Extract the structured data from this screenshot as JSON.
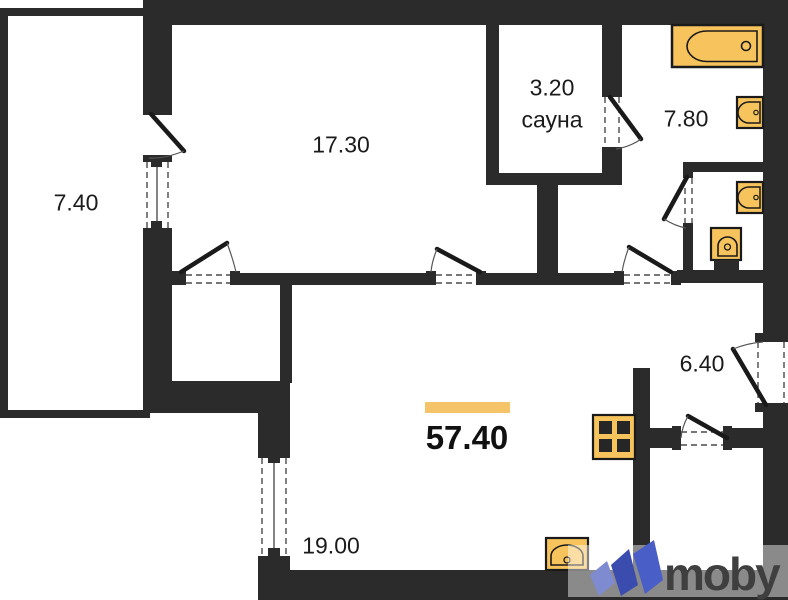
{
  "floorplan": {
    "total_area": "57.40",
    "rooms": [
      {
        "id": "balcony",
        "area": "7.40"
      },
      {
        "id": "living-room",
        "area": "17.30"
      },
      {
        "id": "sauna",
        "area": "3.20",
        "name": "сауна"
      },
      {
        "id": "bathroom",
        "area": "7.80"
      },
      {
        "id": "hallway",
        "area": "6.40"
      },
      {
        "id": "kitchen-living-room",
        "area": "19.00"
      }
    ],
    "fixtures": [
      {
        "id": "bathtub"
      },
      {
        "id": "bathroom-sink"
      },
      {
        "id": "wc-sink"
      },
      {
        "id": "toilet"
      },
      {
        "id": "stove"
      },
      {
        "id": "kitchen-sink"
      }
    ],
    "colors": {
      "wall": "#2b2b2b",
      "fixture_fill": "#f6c35d",
      "accent_bar": "#f5c469"
    }
  },
  "watermark": {
    "brand": "moby",
    "text_color": "#3f3f3f",
    "icon_colors": [
      "#7e8bd0",
      "#3a4cae",
      "#4a5ec8"
    ]
  }
}
